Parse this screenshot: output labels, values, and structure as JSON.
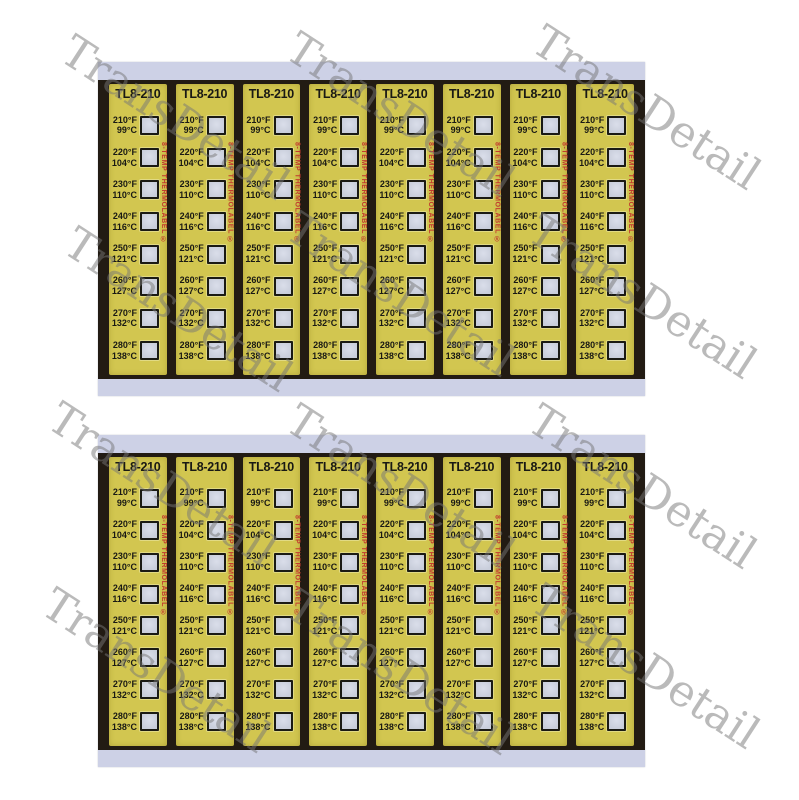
{
  "page": {
    "background": "#ffffff"
  },
  "watermark": {
    "text": "TransDetail",
    "color": "rgba(118,118,118,0.5)",
    "angle_deg": 33,
    "positions": [
      {
        "x": 175,
        "y": 118
      },
      {
        "x": 400,
        "y": 115
      },
      {
        "x": 646,
        "y": 108
      },
      {
        "x": 178,
        "y": 310
      },
      {
        "x": 400,
        "y": 295
      },
      {
        "x": 642,
        "y": 297
      },
      {
        "x": 162,
        "y": 485
      },
      {
        "x": 400,
        "y": 487
      },
      {
        "x": 642,
        "y": 487
      },
      {
        "x": 156,
        "y": 671
      },
      {
        "x": 400,
        "y": 673
      },
      {
        "x": 645,
        "y": 667
      }
    ]
  },
  "label_sheet": {
    "sheet_count": 2,
    "strips_per_sheet": 8,
    "model": "TL8-210",
    "brand_vertical_text": "8-TEMP THERMOLABEL ®",
    "temperatures": [
      {
        "fahrenheit": "210°F",
        "celsius": "99°C"
      },
      {
        "fahrenheit": "220°F",
        "celsius": "104°C"
      },
      {
        "fahrenheit": "230°F",
        "celsius": "110°C"
      },
      {
        "fahrenheit": "240°F",
        "celsius": "116°C"
      },
      {
        "fahrenheit": "250°F",
        "celsius": "121°C"
      },
      {
        "fahrenheit": "260°F",
        "celsius": "127°C"
      },
      {
        "fahrenheit": "270°F",
        "celsius": "132°C"
      },
      {
        "fahrenheit": "280°F",
        "celsius": "138°C"
      }
    ],
    "colors": {
      "strip_background": "#d2c650",
      "sheet_black": "#221b13",
      "band": "#cdd1e6",
      "indicator_fill": "#c9cedb",
      "indicator_border": "#1a1a14",
      "brand_text_color": "#c23a2e",
      "label_text_color": "#191914"
    }
  }
}
